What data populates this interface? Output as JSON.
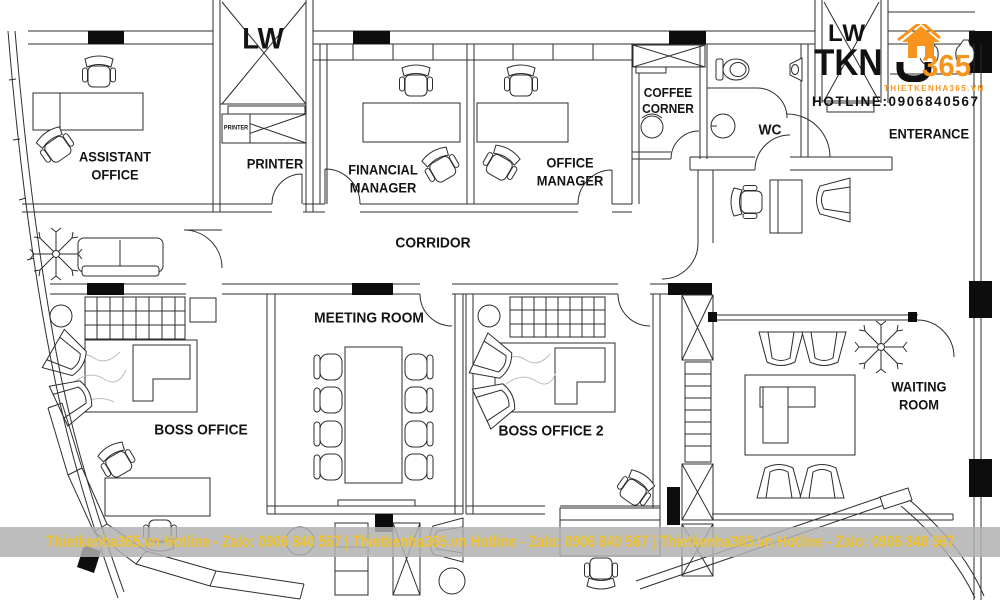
{
  "rooms": {
    "assistant_office": "ASSISTANT\nOFFICE",
    "printer": "PRINTER",
    "financial_manager": "FINANCIAL\nMANAGER",
    "office_manager": "OFFICE\nMANAGER",
    "coffee_corner": "COFFEE\nCORNER",
    "wc": "WC",
    "enterance": "ENTERANCE",
    "corridor": "CORRIDOR",
    "meeting_room": "MEETING ROOM",
    "boss_office": "BOSS OFFICE",
    "boss_office_2": "BOSS OFFICE 2",
    "waiting_room": "WAITING ROOM",
    "elevator": "LW",
    "printer_unit": "PRINTER"
  },
  "watermark": {
    "lw": "LW",
    "tkn": "TKN",
    "num": "365",
    "site": "THIETKENHA365.VN",
    "hotline": "HOTLINE:0906840567"
  },
  "footer": {
    "text": "Thietkenha365.vn Hotline - Zalo: 0906 840 567 | Thietkenha365.vn Hotline - Zalo: 0906 840 567 | Thietkenha365.vn Hotline - Zalo: 0906 840 567"
  },
  "colors": {
    "line": "#2d2d2d",
    "accent_orange": "#F7941E",
    "footer_text": "#EFC32E",
    "footer_band": "#B2B2B2"
  }
}
